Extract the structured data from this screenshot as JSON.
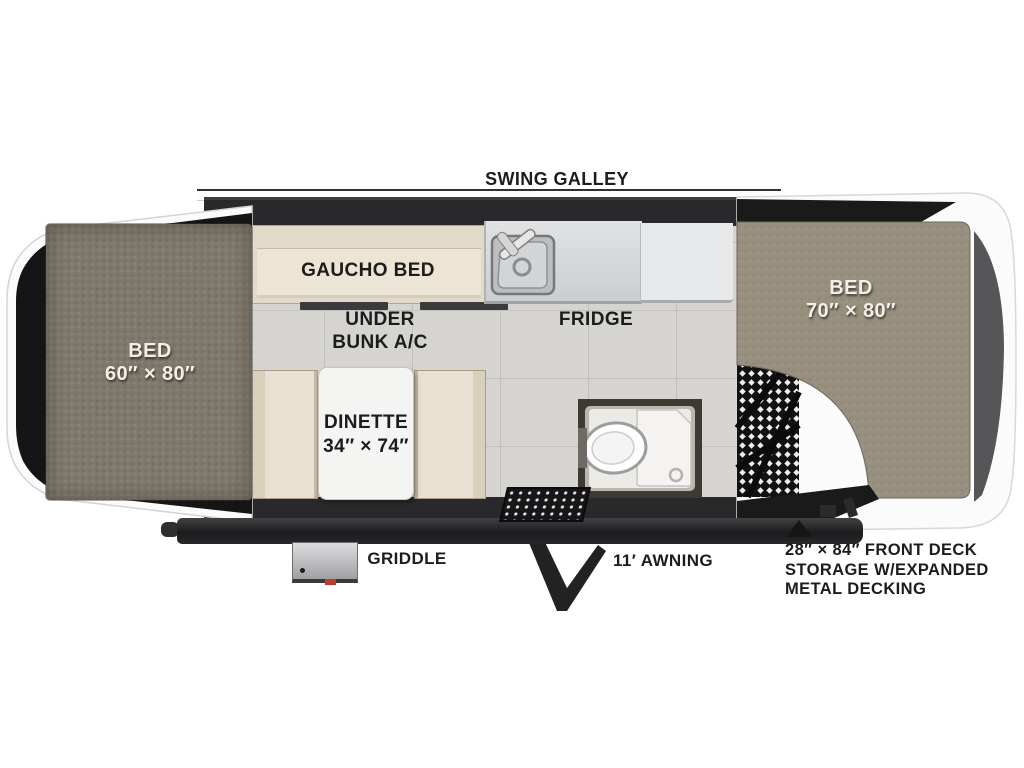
{
  "labels": {
    "swing_galley": "SWING GALLEY",
    "gaucho_bed": "GAUCHO BED",
    "under_bunk": {
      "line1": "UNDER",
      "line2": "BUNK A/C"
    },
    "fridge": "FRIDGE",
    "bed_left": {
      "line1": "BED",
      "line2": "60″ × 80″"
    },
    "bed_right": {
      "line1": "BED",
      "line2": "70″ × 80″"
    },
    "dinette": {
      "line1": "DINETTE",
      "line2": "34″ × 74″"
    },
    "griddle": "GRIDDLE",
    "awning": "11′ AWNING",
    "front_deck": {
      "line1": "28″ × 84″ FRONT DECK",
      "line2": "STORAGE W/EXPANDED",
      "line3": "METAL DECKING"
    }
  },
  "colors": {
    "wall_dark": "#29292b",
    "floor_tile": "#d6d4d0",
    "carpet_left_bed": "#7f786c",
    "carpet_right_bed": "#97907f",
    "cushion_cream": "#e8e0d0",
    "counter_gray": "#d8dadc",
    "mesh_black": "#121213",
    "annotation_text": "#1c1c1c",
    "bed_label_text": "#f2efe8"
  }
}
